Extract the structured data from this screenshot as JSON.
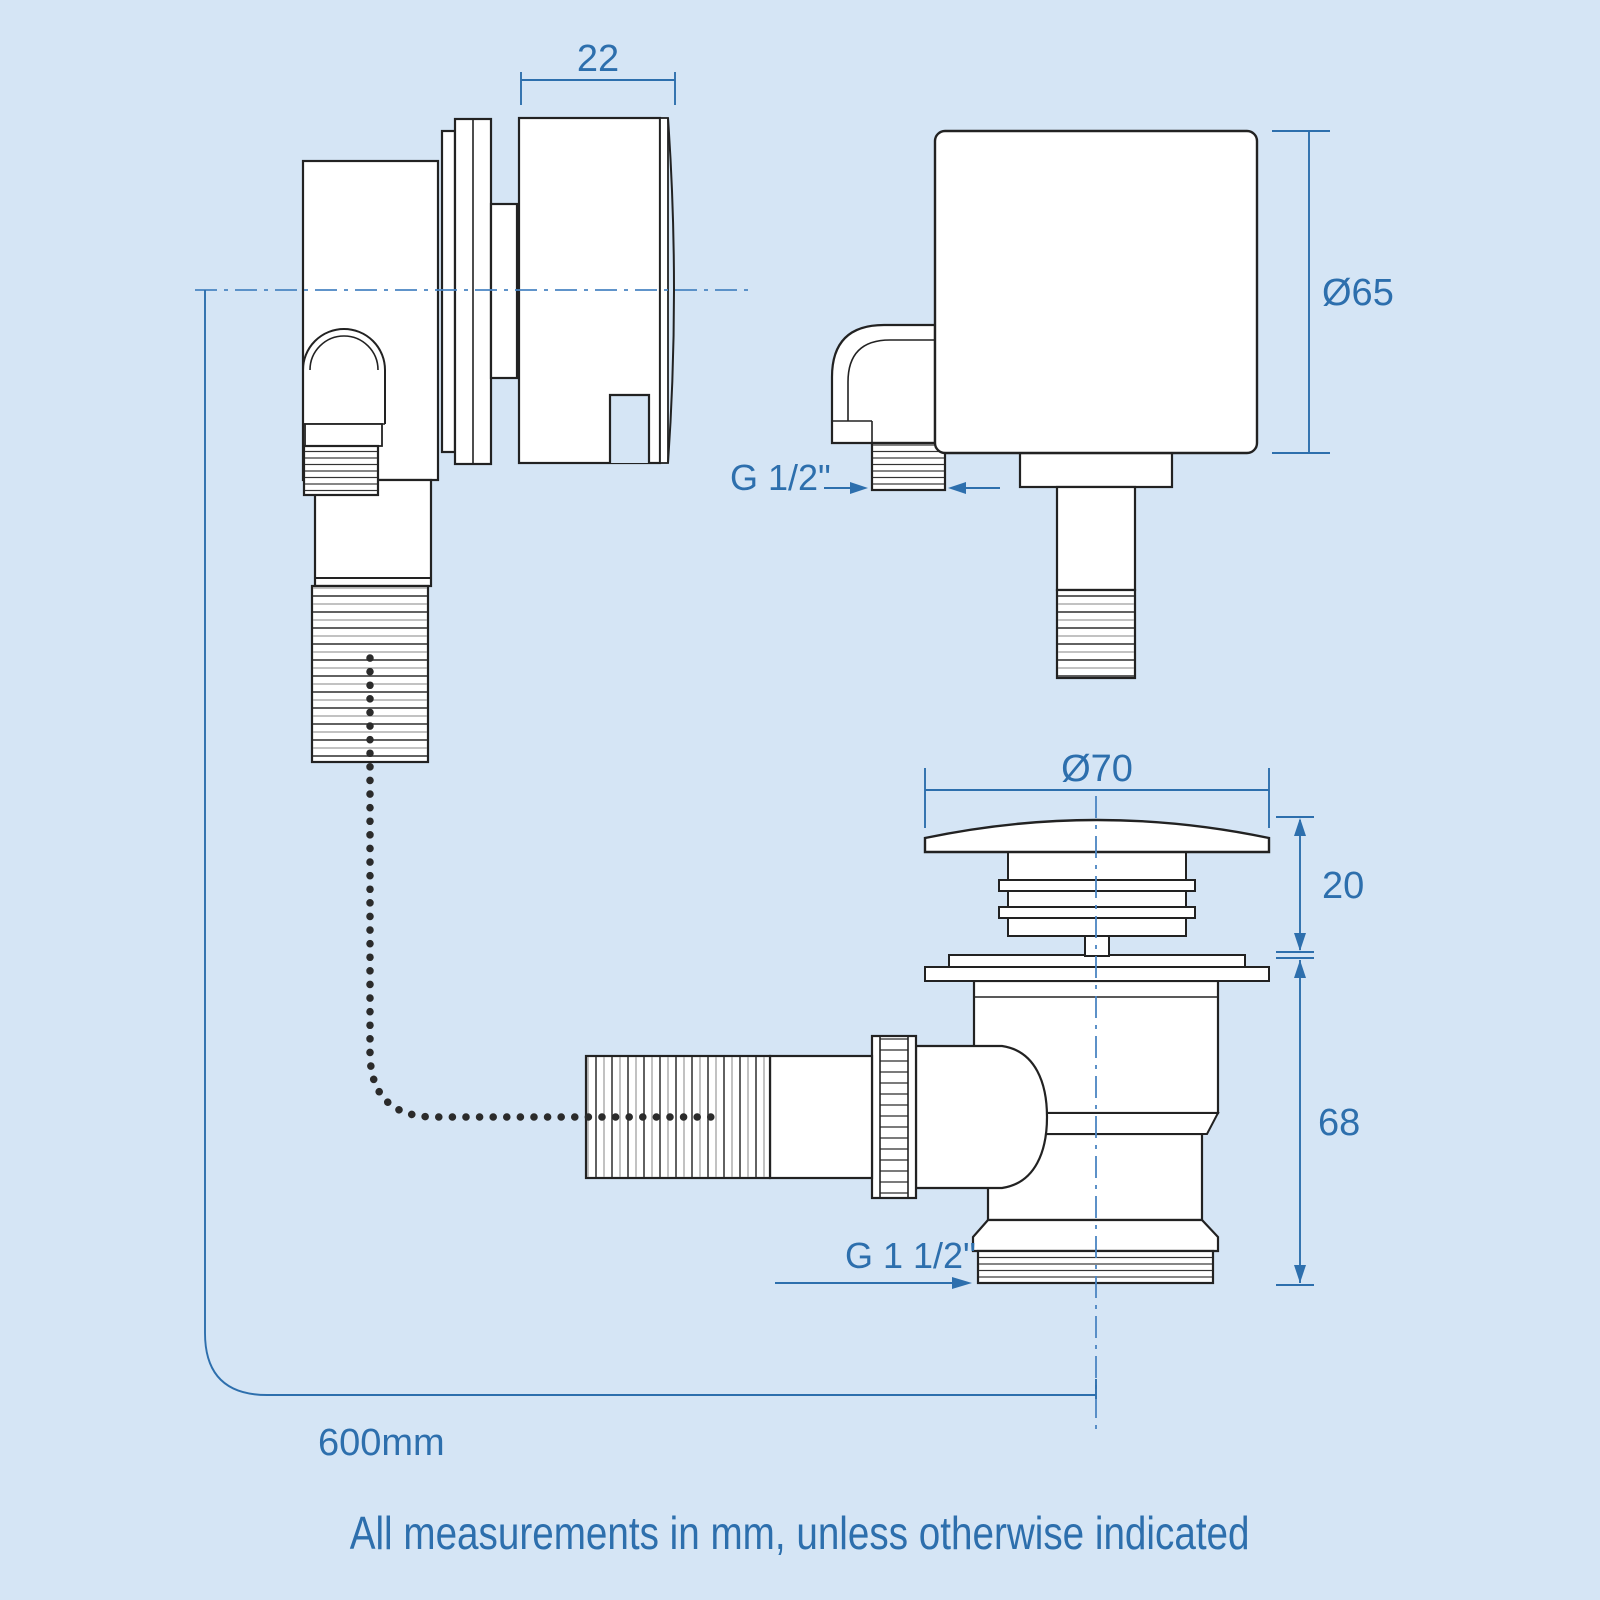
{
  "colors": {
    "background": "#d5e5f5",
    "line": "#222222",
    "annotation_blue": "#2d6fad",
    "centerline_blue": "#4a85c2"
  },
  "views": {
    "overflow_side": {
      "width_dim": "22",
      "hose_length": "600mm"
    },
    "overflow_front": {
      "diameter_dim": "Ø65",
      "thread_dim": "G 1/2\""
    },
    "waste": {
      "cap_diameter_dim": "Ø70",
      "cap_height_dim": "20",
      "body_height_dim": "68",
      "thread_dim": "G 1 1/2\""
    }
  },
  "footer": {
    "note": "All measurements in mm, unless otherwise indicated"
  }
}
